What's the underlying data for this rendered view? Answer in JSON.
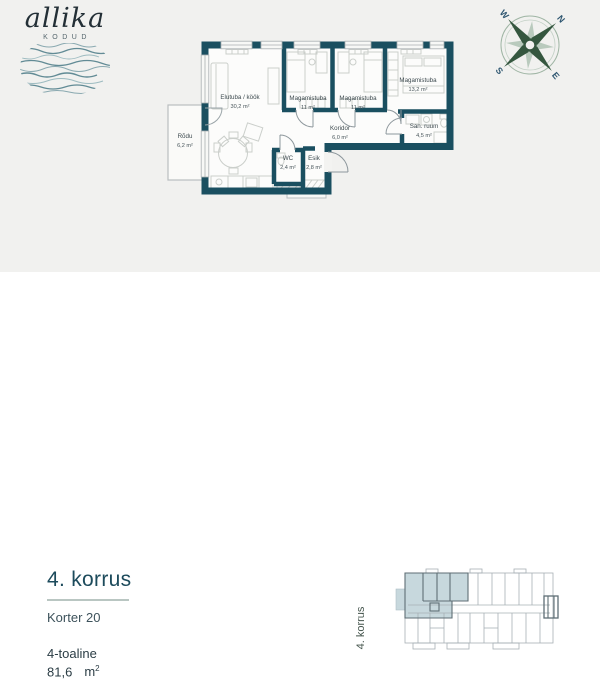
{
  "brand": {
    "name": "allika",
    "tagline": "KODUD"
  },
  "compass": {
    "n": "N",
    "e": "E",
    "s": "S",
    "w": "W"
  },
  "floorplan": {
    "rooms": [
      {
        "name": "Elutuba / köök",
        "area": "30,2 m²"
      },
      {
        "name": "Magamistuba",
        "area": "11 m²"
      },
      {
        "name": "Magamistuba",
        "area": "11 m²"
      },
      {
        "name": "Magamistuba",
        "area": "13,2 m²"
      },
      {
        "name": "Koridor",
        "area": "6,0 m²"
      },
      {
        "name": "San. ruum",
        "area": "4,5 m²"
      },
      {
        "name": "WC",
        "area": "2,4 m²"
      },
      {
        "name": "Esik",
        "area": "2,8 m²"
      },
      {
        "name": "Rõdu",
        "area": "6,2 m²"
      }
    ]
  },
  "details": {
    "floor_title": "4. korrus",
    "apartment_label": "Korter 20",
    "room_count_label": "4-toaline",
    "total_area_value": "81,6",
    "total_area_unit": "m",
    "total_area_sup": "2"
  },
  "overview": {
    "floor_label": "4. korrus"
  },
  "colors": {
    "wall": "#1a4f60",
    "accent": "#1d4b5c",
    "highlight": "#c7d8dd"
  }
}
